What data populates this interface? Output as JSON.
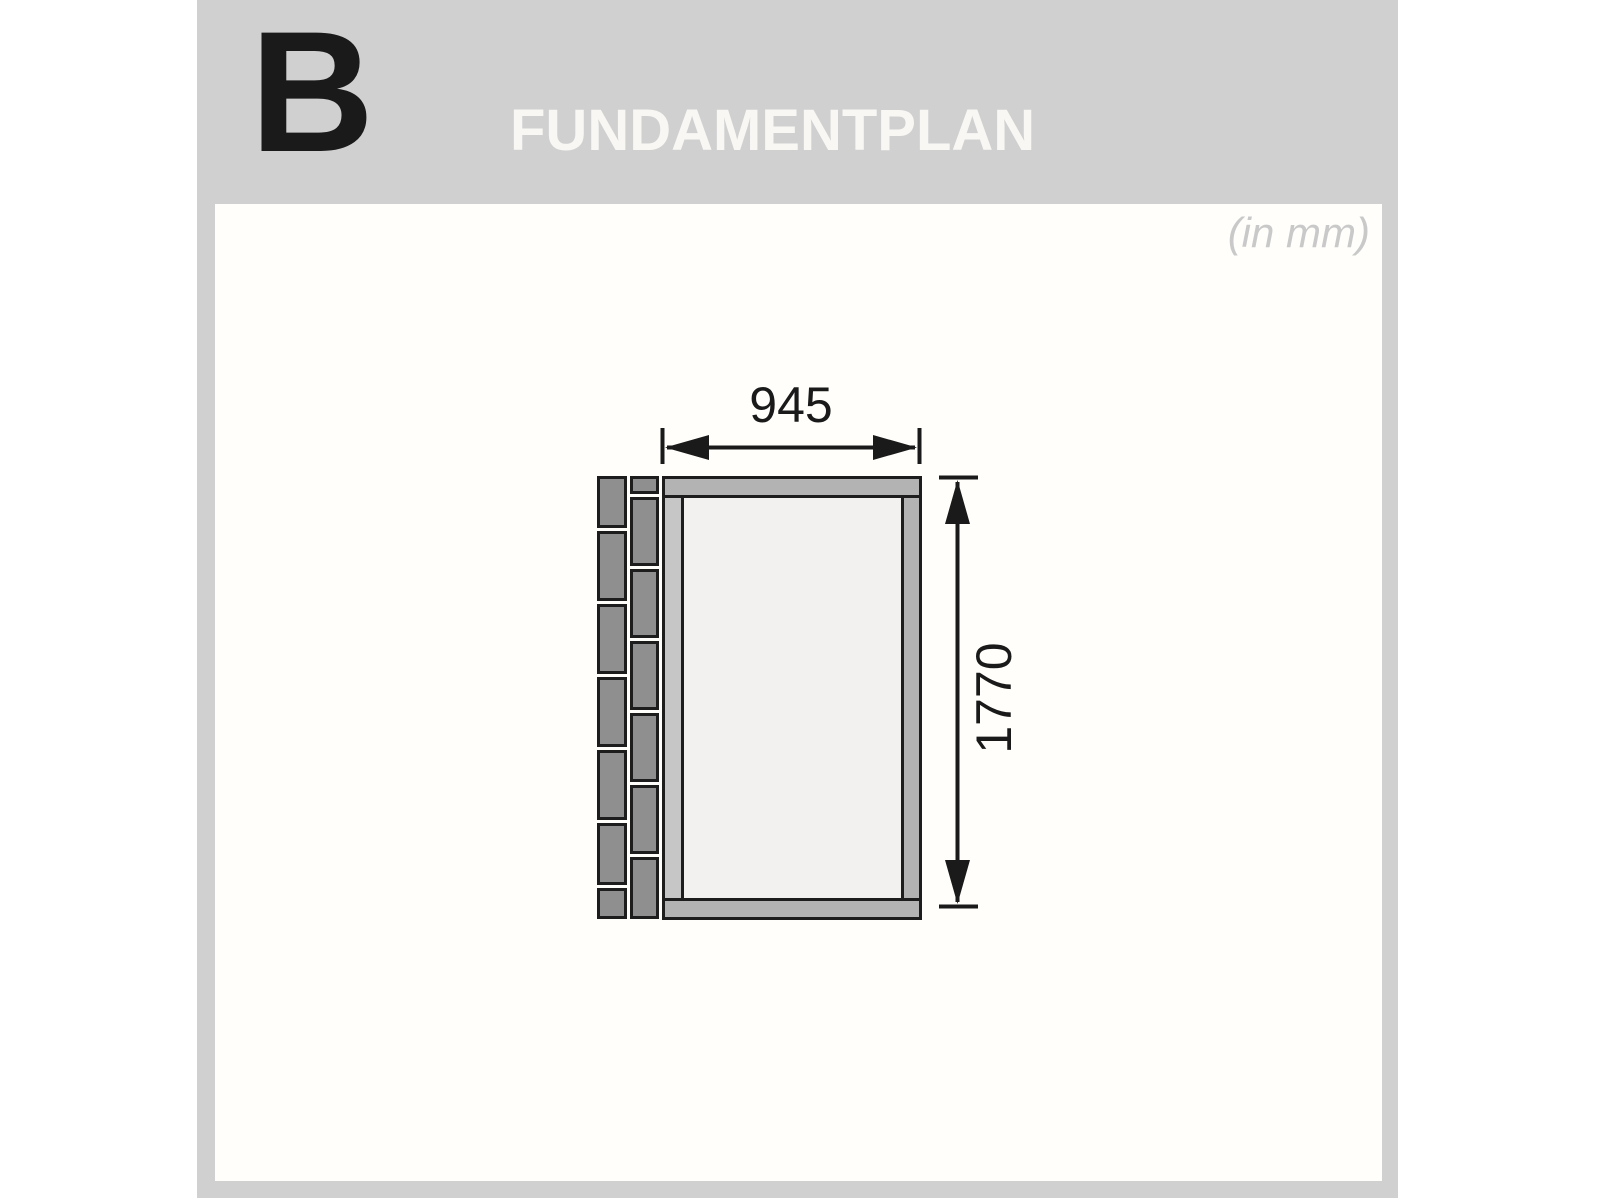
{
  "header": {
    "section_letter": "B",
    "title": "FUNDAMENTPLAN",
    "units_note": "(in mm)"
  },
  "drawing": {
    "width_label": "945",
    "height_label": "1770"
  },
  "colors": {
    "panel_gray": "#d0d0d0",
    "content_background": "#fffefa",
    "title_text": "#f8f7f4",
    "section_letter_ink": "#1a1a1a",
    "units_note_text": "#c9c9c9",
    "brick_fill": "#8f8f8f",
    "outline_ink": "#1d1d1d",
    "frame_bar_fill": "#b3b3b3",
    "frame_side_fill": "#c6c6c6",
    "floor_fill": "#f2f1ef",
    "dimension_ink": "#1a1a1a"
  }
}
